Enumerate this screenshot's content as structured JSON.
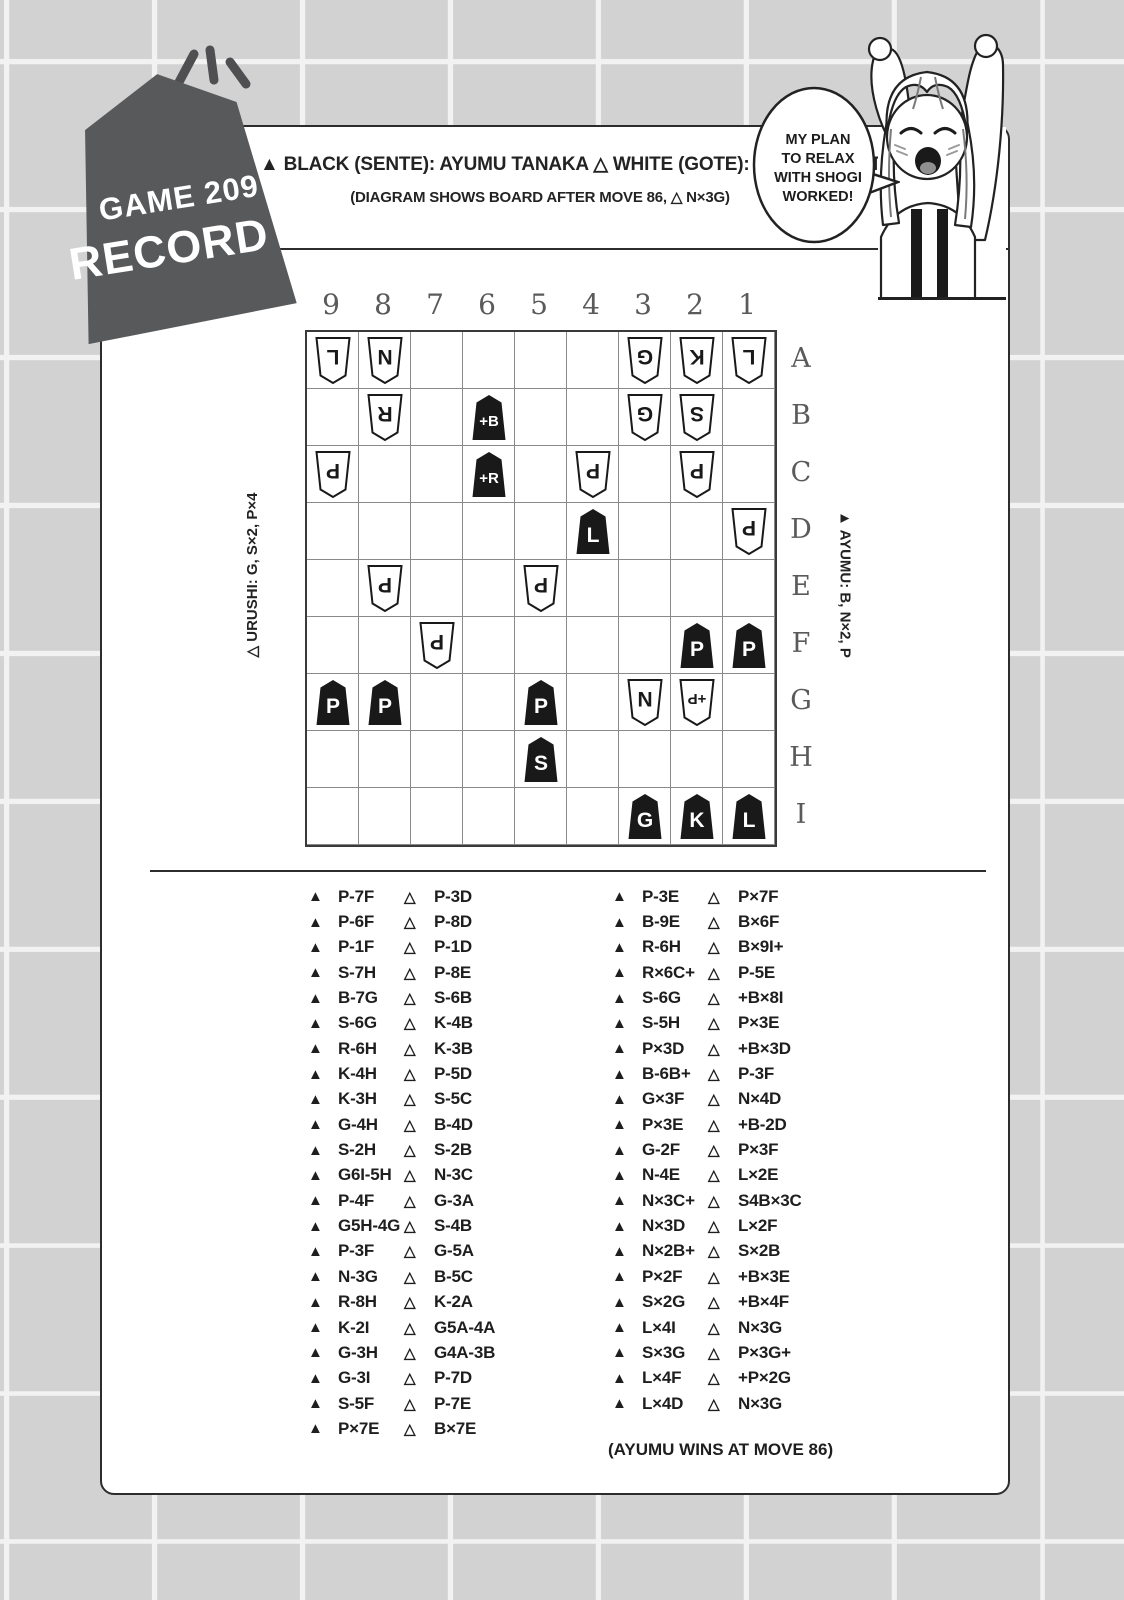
{
  "colors": {
    "bg": "#d2d2d2",
    "grid_line": "#f2f2f2",
    "card_bg": "#ffffff",
    "ink": "#232323",
    "badge_bg": "#58595b",
    "board_line": "#8a8a8a",
    "board_border": "#3a3a3a",
    "label_gray": "#5a5a5a"
  },
  "badge": {
    "line1": "GAME 209",
    "line2": "RECORD 2"
  },
  "header": {
    "players": "▲ BLACK (SENTE): AYUMU TANAKA  △ WHITE (GOTE): URUSHI YAOTOME",
    "subtitle": "(DIAGRAM SHOWS BOARD AFTER MOVE 86, △ N×3G)"
  },
  "speech_bubble": {
    "lines": [
      "MY PLAN",
      "TO RELAX",
      "WITH SHOGI",
      "WORKED!"
    ]
  },
  "board": {
    "columns": [
      "9",
      "8",
      "7",
      "6",
      "5",
      "4",
      "3",
      "2",
      "1"
    ],
    "rows": [
      "A",
      "B",
      "C",
      "D",
      "E",
      "F",
      "G",
      "H",
      "I"
    ],
    "pieces": [
      {
        "square": "9A",
        "side": "white",
        "piece": "lance",
        "kanji": "香",
        "label": "L"
      },
      {
        "square": "8A",
        "side": "white",
        "piece": "knight",
        "kanji": "桂",
        "label": "N"
      },
      {
        "square": "3A",
        "side": "white",
        "piece": "gold",
        "kanji": "金",
        "label": "G"
      },
      {
        "square": "2A",
        "side": "white",
        "piece": "king",
        "kanji": "王",
        "label": "K"
      },
      {
        "square": "1A",
        "side": "white",
        "piece": "lance",
        "kanji": "香",
        "label": "L"
      },
      {
        "square": "8B",
        "side": "white",
        "piece": "rook",
        "kanji": "飛",
        "label": "R"
      },
      {
        "square": "6B",
        "side": "black",
        "piece": "horse",
        "kanji": "馬",
        "label": "+B"
      },
      {
        "square": "3B",
        "side": "white",
        "piece": "gold",
        "kanji": "金",
        "label": "G"
      },
      {
        "square": "2B",
        "side": "white",
        "piece": "silver",
        "kanji": "銀",
        "label": "S"
      },
      {
        "square": "9C",
        "side": "white",
        "piece": "pawn",
        "kanji": "歩",
        "label": "P"
      },
      {
        "square": "6C",
        "side": "black",
        "piece": "dragon",
        "kanji": "龍",
        "label": "+R"
      },
      {
        "square": "4C",
        "side": "white",
        "piece": "pawn",
        "kanji": "歩",
        "label": "P"
      },
      {
        "square": "2C",
        "side": "white",
        "piece": "pawn",
        "kanji": "歩",
        "label": "P"
      },
      {
        "square": "4D",
        "side": "black",
        "piece": "lance",
        "kanji": "香",
        "label": "L"
      },
      {
        "square": "1D",
        "side": "white",
        "piece": "pawn",
        "kanji": "歩",
        "label": "P"
      },
      {
        "square": "8E",
        "side": "white",
        "piece": "pawn",
        "kanji": "歩",
        "label": "P"
      },
      {
        "square": "5E",
        "side": "white",
        "piece": "pawn",
        "kanji": "歩",
        "label": "P"
      },
      {
        "square": "7F",
        "side": "white",
        "piece": "pawn",
        "kanji": "歩",
        "label": "P"
      },
      {
        "square": "2F",
        "side": "black",
        "piece": "pawn",
        "kanji": "歩",
        "label": "P"
      },
      {
        "square": "1F",
        "side": "black",
        "piece": "pawn",
        "kanji": "歩",
        "label": "P"
      },
      {
        "square": "9G",
        "side": "black",
        "piece": "pawn",
        "kanji": "歩",
        "label": "P"
      },
      {
        "square": "8G",
        "side": "black",
        "piece": "pawn",
        "kanji": "歩",
        "label": "P"
      },
      {
        "square": "5G",
        "side": "black",
        "piece": "pawn",
        "kanji": "歩",
        "label": "P"
      },
      {
        "square": "3G",
        "side": "white",
        "piece": "knight",
        "kanji": "桂",
        "label": "N"
      },
      {
        "square": "2G",
        "side": "white",
        "piece": "tokin",
        "kanji": "と",
        "label": "+P"
      },
      {
        "square": "5H",
        "side": "black",
        "piece": "silver",
        "kanji": "銀",
        "label": "S"
      },
      {
        "square": "3I",
        "side": "black",
        "piece": "gold",
        "kanji": "金",
        "label": "G"
      },
      {
        "square": "2I",
        "side": "black",
        "piece": "king",
        "kanji": "玉",
        "label": "K"
      },
      {
        "square": "1I",
        "side": "black",
        "piece": "lance",
        "kanji": "香",
        "label": "L"
      }
    ]
  },
  "hands": {
    "white": "△ URUSHI: G, S×2, P×4",
    "black": "▲ AYUMU: B, N×2, P"
  },
  "marks": {
    "black": "▲",
    "white": "△"
  },
  "moves": {
    "left": [
      {
        "b": "P-7F",
        "w": "P-3D"
      },
      {
        "b": "P-6F",
        "w": "P-8D"
      },
      {
        "b": "P-1F",
        "w": "P-1D"
      },
      {
        "b": "S-7H",
        "w": "P-8E"
      },
      {
        "b": "B-7G",
        "w": "S-6B"
      },
      {
        "b": "S-6G",
        "w": "K-4B"
      },
      {
        "b": "R-6H",
        "w": "K-3B"
      },
      {
        "b": "K-4H",
        "w": "P-5D"
      },
      {
        "b": "K-3H",
        "w": "S-5C"
      },
      {
        "b": "G-4H",
        "w": "B-4D"
      },
      {
        "b": "S-2H",
        "w": "S-2B"
      },
      {
        "b": "G6I-5H",
        "w": "N-3C"
      },
      {
        "b": "P-4F",
        "w": "G-3A"
      },
      {
        "b": "G5H-4G",
        "w": "S-4B"
      },
      {
        "b": "P-3F",
        "w": "G-5A"
      },
      {
        "b": "N-3G",
        "w": "B-5C"
      },
      {
        "b": "R-8H",
        "w": "K-2A"
      },
      {
        "b": "K-2I",
        "w": "G5A-4A"
      },
      {
        "b": "G-3H",
        "w": "G4A-3B"
      },
      {
        "b": "G-3I",
        "w": "P-7D"
      },
      {
        "b": "S-5F",
        "w": "P-7E"
      },
      {
        "b": "P×7E",
        "w": "B×7E"
      }
    ],
    "right": [
      {
        "b": "P-3E",
        "w": "P×7F"
      },
      {
        "b": "B-9E",
        "w": "B×6F"
      },
      {
        "b": "R-6H",
        "w": "B×9I+"
      },
      {
        "b": "R×6C+",
        "w": "P-5E"
      },
      {
        "b": "S-6G",
        "w": "+B×8I"
      },
      {
        "b": "S-5H",
        "w": "P×3E"
      },
      {
        "b": "P×3D",
        "w": "+B×3D"
      },
      {
        "b": "B-6B+",
        "w": "P-3F"
      },
      {
        "b": "G×3F",
        "w": "N×4D"
      },
      {
        "b": "P×3E",
        "w": "+B-2D"
      },
      {
        "b": "G-2F",
        "w": "P×3F"
      },
      {
        "b": "N-4E",
        "w": "L×2E"
      },
      {
        "b": "N×3C+",
        "w": "S4B×3C"
      },
      {
        "b": "N×3D",
        "w": "L×2F"
      },
      {
        "b": "N×2B+",
        "w": "S×2B"
      },
      {
        "b": "P×2F",
        "w": "+B×3E"
      },
      {
        "b": "S×2G",
        "w": "+B×4F"
      },
      {
        "b": "L×4I",
        "w": "N×3G"
      },
      {
        "b": "S×3G",
        "w": "P×3G+"
      },
      {
        "b": "L×4F",
        "w": "+P×2G"
      },
      {
        "b": "L×4D",
        "w": "N×3G"
      }
    ],
    "result": "(AYUMU WINS AT MOVE 86)"
  }
}
